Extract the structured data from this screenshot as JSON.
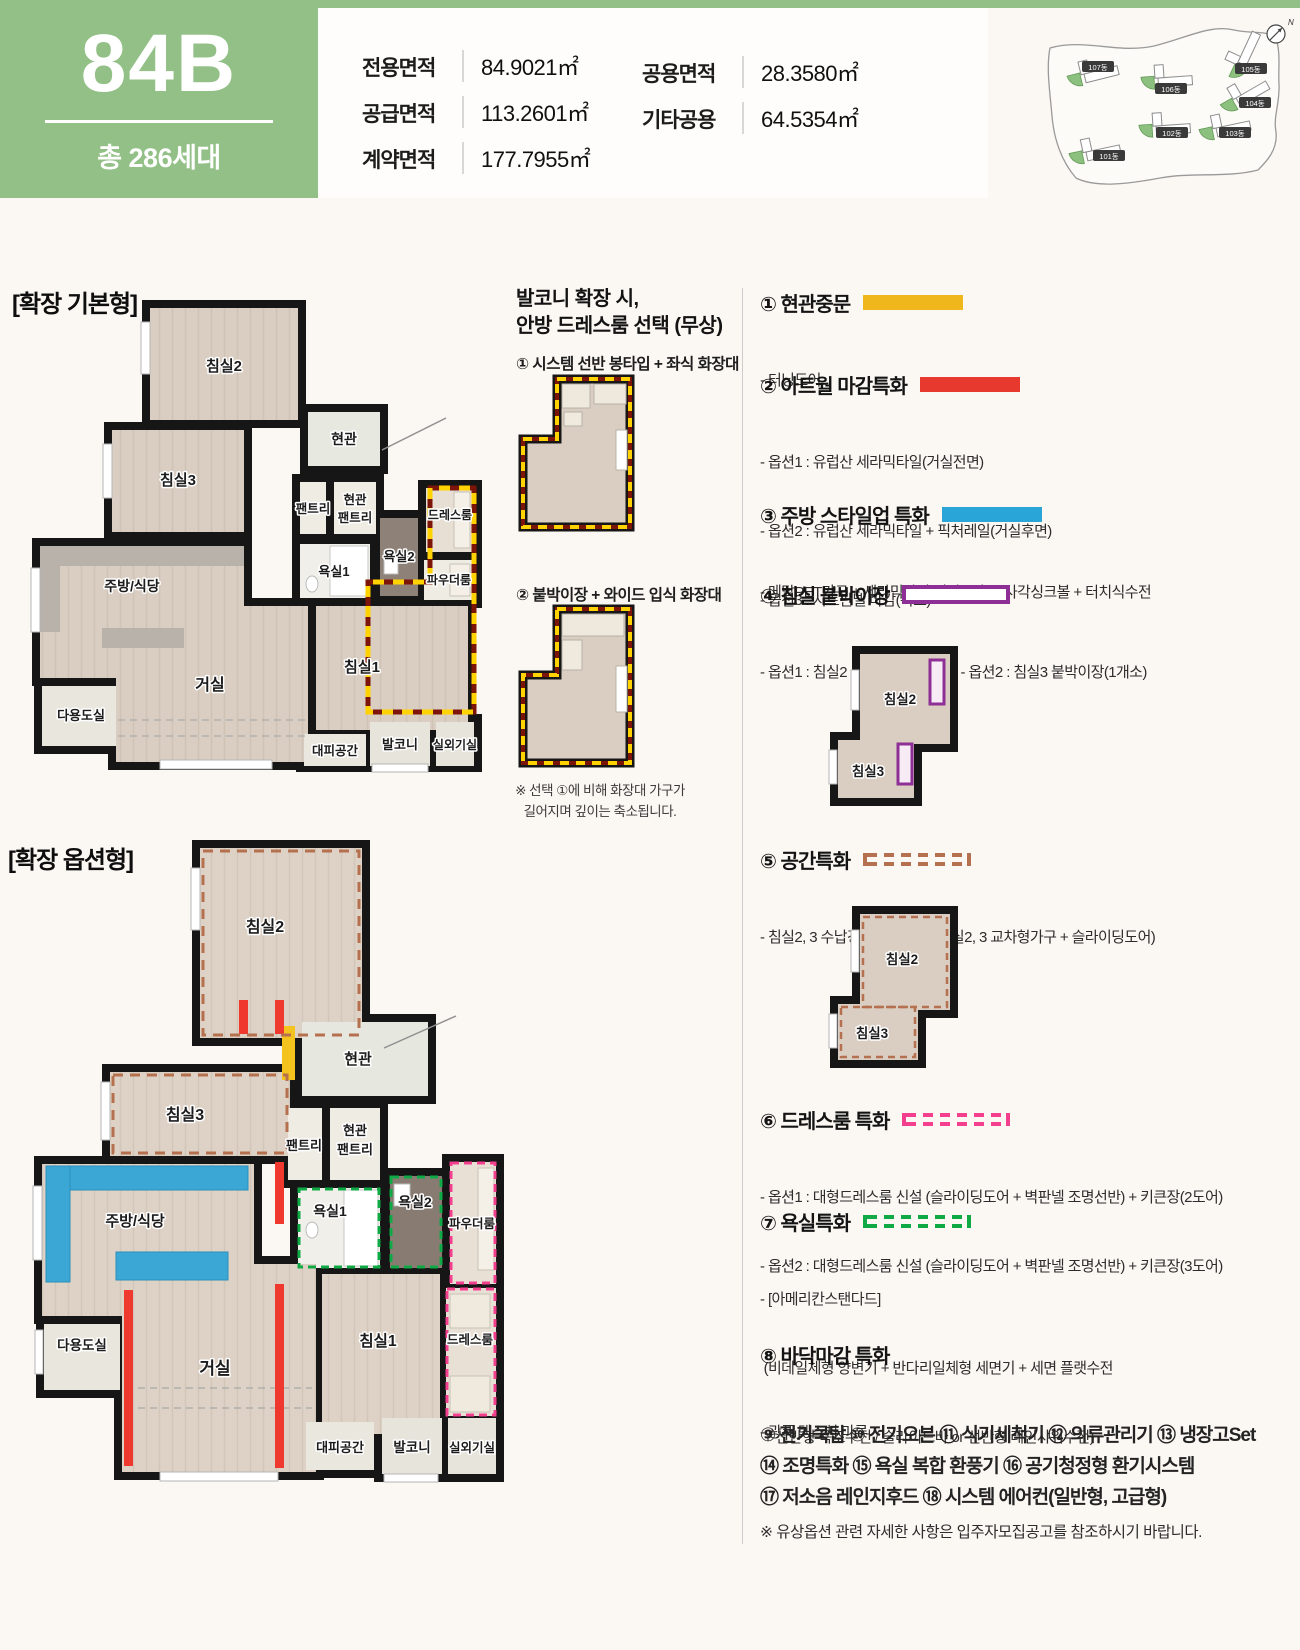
{
  "header": {
    "unit_type": "84B",
    "total_units": "총 286세대",
    "areas_col1": [
      {
        "label": "전용면적",
        "value": "84.9021㎡"
      },
      {
        "label": "공급면적",
        "value": "113.2601㎡"
      },
      {
        "label": "계약면적",
        "value": "177.7955㎡"
      }
    ],
    "areas_col2": [
      {
        "label": "공용면적",
        "value": "28.3580㎡"
      },
      {
        "label": "기타공용",
        "value": "64.5354㎡"
      }
    ]
  },
  "site_map": {
    "compass": "N",
    "buildings": [
      "101동",
      "102동",
      "103동",
      "104동",
      "105동",
      "106동",
      "107동"
    ]
  },
  "plan_basic": {
    "title": "[확장 기본형]",
    "rooms": {
      "bed2": "침실2",
      "bed3": "침실3",
      "entry": "현관",
      "pantry": "팬트리",
      "hall_pantry1": "현관",
      "hall_pantry2": "팬트리",
      "bath1": "욕실1",
      "bath2": "욕실2",
      "dress": "드레스룸",
      "powder": "파우더룸",
      "kitchen": "주방/식당",
      "utility": "다용도실",
      "living": "거실",
      "bed1": "침실1",
      "shelter": "대피공간",
      "balcony": "발코니",
      "ac": "실외기실"
    }
  },
  "plan_option": {
    "title": "[확장 옵션형]",
    "rooms": {
      "bed2": "침실2",
      "bed3": "침실3",
      "entry": "현관",
      "pantry": "팬트리",
      "hall_pantry1": "현관",
      "hall_pantry2": "팬트리",
      "bath1": "욕실1",
      "bath2": "욕실2",
      "dress": "드레스룸",
      "powder": "파우더룸",
      "kitchen": "주방/식당",
      "utility": "다용도실",
      "living": "거실",
      "bed1": "침실1",
      "shelter": "대피공간",
      "balcony": "발코니",
      "ac": "실외기실"
    }
  },
  "balcony_option": {
    "title_line1": "발코니 확장 시,",
    "title_line2": "안방 드레스룸 선택 (무상)",
    "option1": "① 시스템 선반 봉타입 + 좌식 화장대",
    "option2": "② 붙박이장 + 와이드 입식 화장대",
    "note_line1": "※ 선택 ①에 비해 화장대 가구가",
    "note_line2": "길어지며 깊이는 축소됩니다."
  },
  "legend": {
    "items": [
      {
        "title": "① 현관중문",
        "lines": [
          "- 터닝도어"
        ]
      },
      {
        "title": "② 아트월 마감특화",
        "lines": [
          "- 옵션1 : 유럽산 세라믹타일(거실전면)",
          "- 옵션2 : 유럽산 세라믹타일 + 픽처레일(거실후면)",
          "- 옵션3 : 시트판넬 마감(복도)"
        ]
      },
      {
        "title": "③ 주방 스타일업 특화",
        "lines": [
          "- 메탈PET가구 + 세라믹타일(상판 / 벽) + 사각싱크볼 + 터치식수전"
        ]
      },
      {
        "title": "④ 침실 붙박이장",
        "lines": [
          "- 옵션1 : 침실2 붙박이장(1개소)    - 옵션2 : 침실3 붙박이장(1개소)"
        ]
      },
      {
        "title": "⑤ 공간특화",
        "lines": [
          "- 침실2, 3 수납강화 특화 변경(침실2, 3 교차형가구 + 슬라이딩도어)"
        ]
      },
      {
        "title": "⑥ 드레스룸 특화",
        "lines": [
          "- 옵션1 : 대형드레스룸 신설 (슬라이딩도어 + 벽판넬 조명선반) + 키큰장(2도어)",
          "- 옵션2 : 대형드레스룸 신설 (슬라이딩도어 + 벽판넬 조명선반) + 키큰장(3도어)"
        ]
      },
      {
        "title": "⑦ 욕실특화",
        "lines": [
          "- [아메리칸스탠다드]",
          " (비데일체형 양변기 + 반다리일체형 세면기 + 세면 플랫수전",
          " + 선반형 욕조수전 / 슬라이드바 or 선반형 레인샤워수전)"
        ]
      },
      {
        "title": "⑧ 바닥마감 특화",
        "lines": [
          "- 광폭 텍스처 마루"
        ]
      }
    ]
  },
  "thumb_wardrobe": {
    "bed2": "침실2",
    "bed3": "침실3"
  },
  "thumb_space": {
    "bed2": "침실2",
    "bed3": "침실3"
  },
  "appliances": {
    "rows": [
      "⑨ 전기쿡탑 ⑩ 전기오븐 ⑪ 식기세척기 ⑫ 의류관리기 ⑬ 냉장고Set",
      "⑭ 조명특화 ⑮ 욕실 복합 환풍기 ⑯ 공기청정형 환기시스템",
      "⑰ 저소음 레인지후드 ⑱ 시스템 에어컨(일반형, 고급형)"
    ]
  },
  "footnote": "※ 유상옵션 관련 자세한 사항은 입주자모집공고를 참조하시기 바랍니다.",
  "colors": {
    "brand_green": "#93c087",
    "opt_yellow": "#f0b71c",
    "opt_red": "#e8392e",
    "opt_blue": "#29a5d8",
    "opt_purple": "#8e2f96",
    "opt_brown": "#b5714f",
    "opt_pink": "#f43f8e",
    "opt_green": "#0faa46"
  }
}
